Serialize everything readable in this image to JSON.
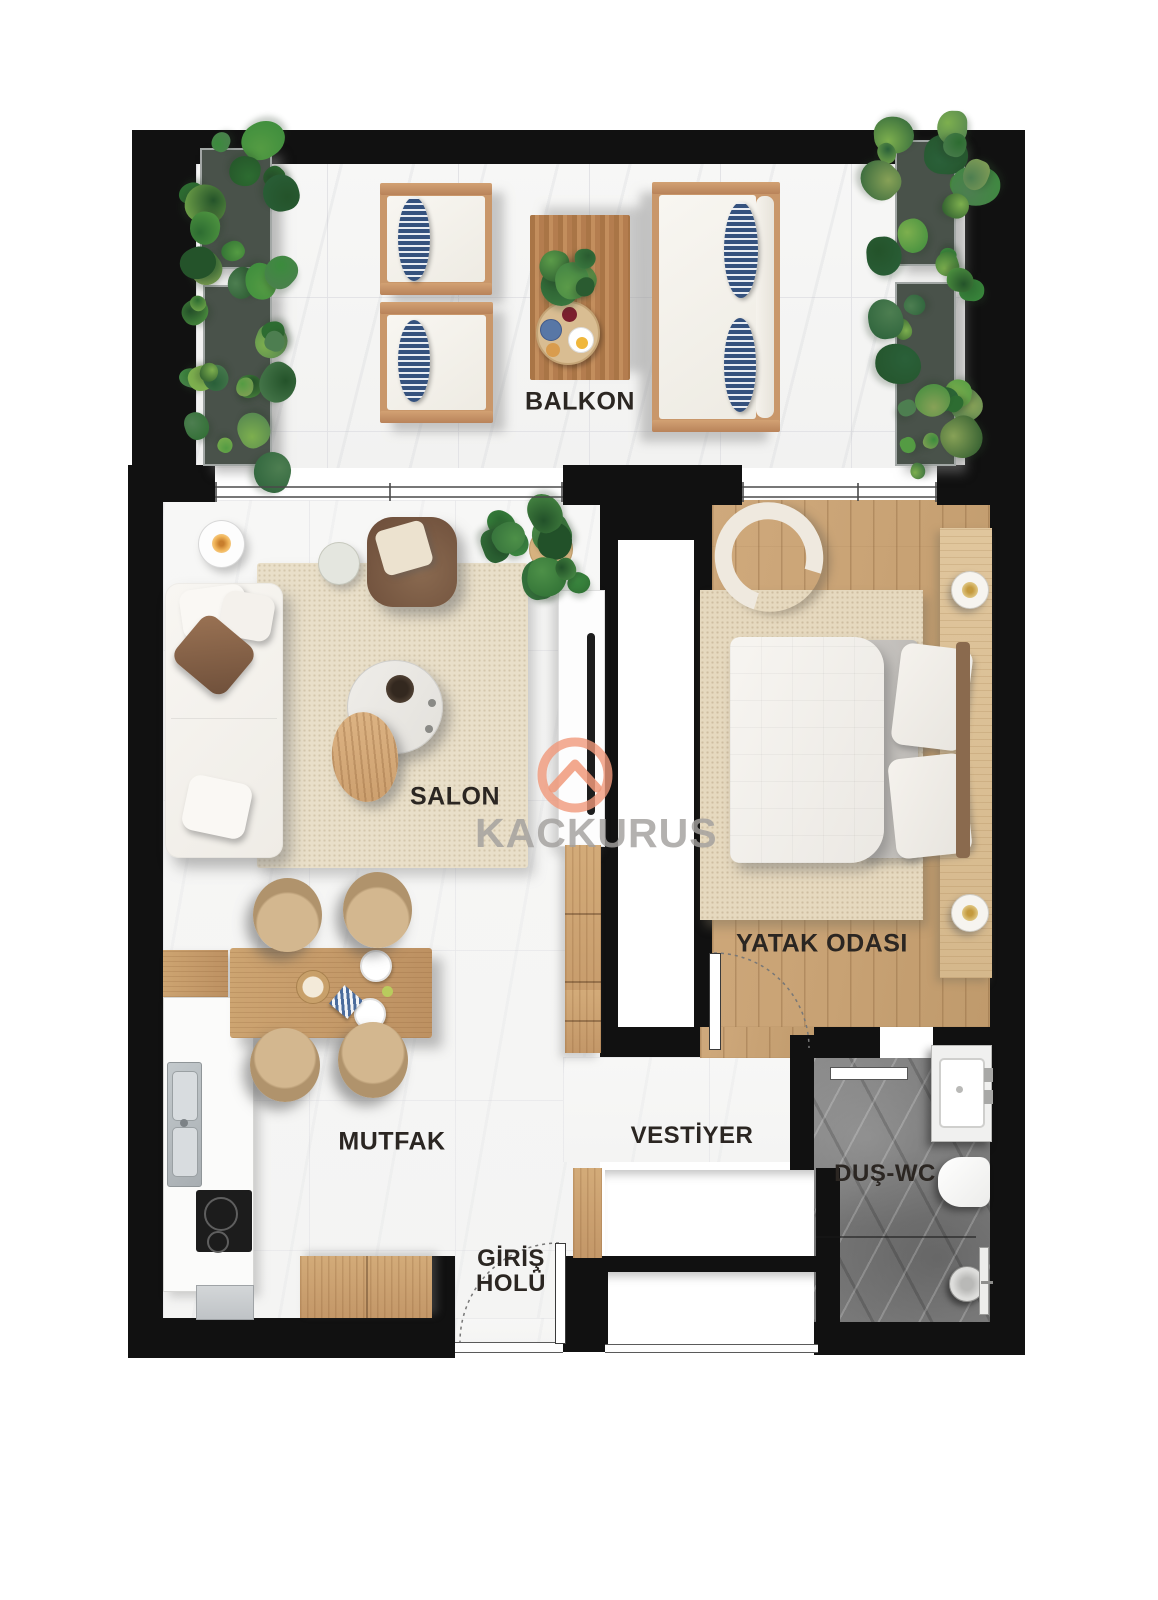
{
  "watermark": {
    "brand": "KACKURUS"
  },
  "rooms": {
    "balcony": {
      "label": "BALKON"
    },
    "living_room": {
      "label": "SALON"
    },
    "bedroom": {
      "label": "YATAK ODASI"
    },
    "kitchen": {
      "label": "MUTFAK"
    },
    "cloakroom": {
      "label": "VESTİYER"
    },
    "shower_wc": {
      "label": "DUŞ-WC"
    },
    "entrance_hall": {
      "label_line1": "GİRİŞ",
      "label_line2": "HOLÜ"
    }
  },
  "colors": {
    "wall": "#111111",
    "wood_floor": "#c8a274",
    "marble_light": "#f5f5f4",
    "bathroom_marble": "#787878",
    "accent_logo": "#f0997a",
    "pillow_stripe_blue": "#35527e",
    "rug_beige": "#e9dfc9"
  }
}
